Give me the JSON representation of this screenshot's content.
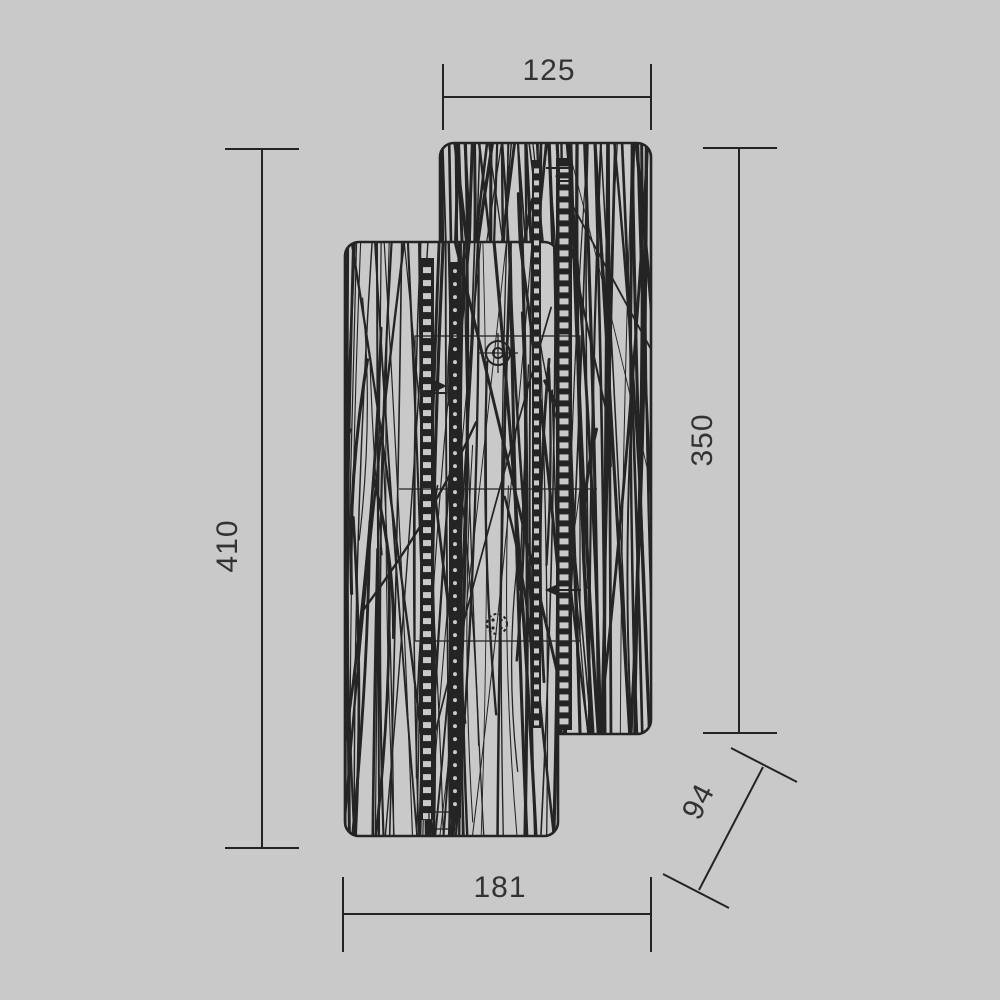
{
  "drawing": {
    "type": "technical dimension drawing",
    "subject": "wall lamp with two overlapping rounded panels and organic line texture",
    "symbols": [
      "screw-crosshair-icon",
      "screw-dotted-icon",
      "mounting-rail",
      "direction-arrow-icon"
    ]
  },
  "dims": {
    "top_width": "125",
    "right_height": "350",
    "left_height": "410",
    "bottom_width": "181",
    "diagonal_depth": "94"
  },
  "colors": {
    "background": "#c9c9c9",
    "ink": "#242424",
    "label": "#333333"
  }
}
